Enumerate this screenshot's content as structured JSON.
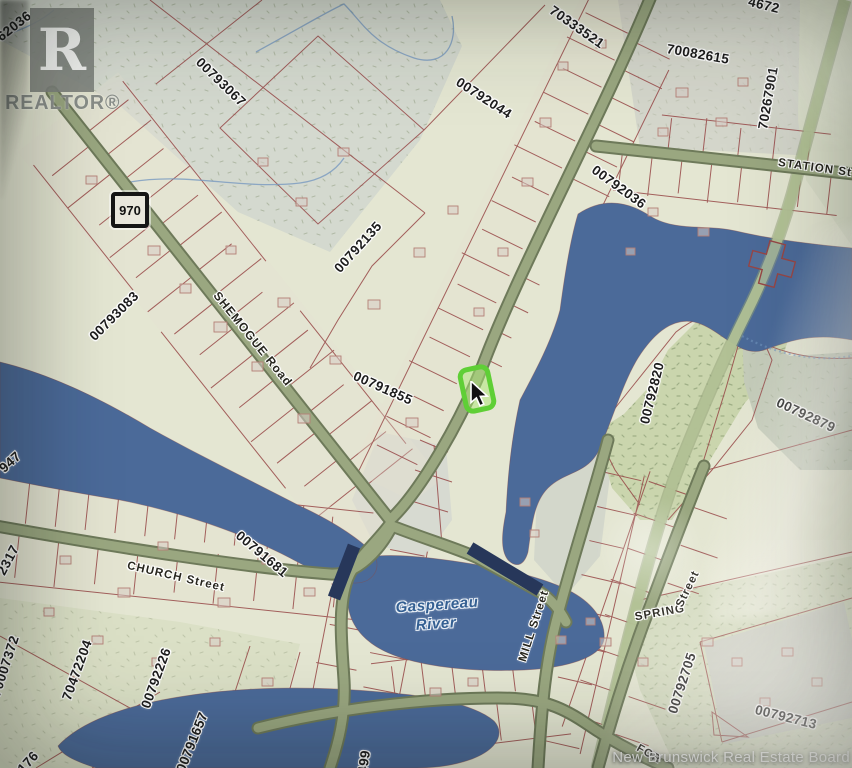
{
  "branding": {
    "logo_letter": "R",
    "logo_text": "REALTOR®",
    "credit": "New Brunswick Real Estate Board"
  },
  "route_shield": {
    "number": "970"
  },
  "selection": {
    "highlight_color": "#58d32b"
  },
  "cursor": {
    "icon": "arrow-pointer"
  },
  "colors": {
    "water": "#486a9d",
    "land": "#e6e8d2",
    "road": "#9aa87e",
    "rail_strip": "#b3c493",
    "parcel_line": "#9c4444",
    "bridge": "#24365c",
    "highlight": "#58d32b",
    "label_halo": "#ffffff"
  },
  "labels": {
    "parcels": [
      {
        "text": "62036",
        "x": 14,
        "y": 26,
        "rot": -38
      },
      {
        "text": "00793067",
        "x": 221,
        "y": 82,
        "rot": 44
      },
      {
        "text": "00792044",
        "x": 484,
        "y": 98,
        "rot": 33
      },
      {
        "text": "70333521",
        "x": 577,
        "y": 27,
        "rot": 35
      },
      {
        "text": "4672",
        "x": 764,
        "y": 5,
        "rot": 14
      },
      {
        "text": "70082615",
        "x": 698,
        "y": 54,
        "rot": 10
      },
      {
        "text": "70267901",
        "x": 768,
        "y": 98,
        "rot": -80
      },
      {
        "text": "00792036",
        "x": 619,
        "y": 187,
        "rot": 36
      },
      {
        "text": "00792135",
        "x": 358,
        "y": 247,
        "rot": -48
      },
      {
        "text": "00793083",
        "x": 114,
        "y": 316,
        "rot": -45
      },
      {
        "text": "00791855",
        "x": 383,
        "y": 388,
        "rot": 24
      },
      {
        "text": "00792820",
        "x": 652,
        "y": 393,
        "rot": -76
      },
      {
        "text": "00792879",
        "x": 806,
        "y": 415,
        "rot": 25
      },
      {
        "text": "947",
        "x": 10,
        "y": 462,
        "rot": -42
      },
      {
        "text": "2317",
        "x": 8,
        "y": 560,
        "rot": -62
      },
      {
        "text": "00791681",
        "x": 262,
        "y": 554,
        "rot": 40
      },
      {
        "text": "70007372",
        "x": 5,
        "y": 666,
        "rot": -72
      },
      {
        "text": "70472204",
        "x": 77,
        "y": 670,
        "rot": -70
      },
      {
        "text": "00792226",
        "x": 156,
        "y": 678,
        "rot": -70
      },
      {
        "text": "00791657",
        "x": 192,
        "y": 742,
        "rot": -68
      },
      {
        "text": "176",
        "x": 28,
        "y": 762,
        "rot": -48
      },
      {
        "text": "499",
        "x": 364,
        "y": 762,
        "rot": -82
      },
      {
        "text": "00792705",
        "x": 682,
        "y": 683,
        "rot": -72
      },
      {
        "text": "00792713",
        "x": 786,
        "y": 717,
        "rot": 14
      }
    ],
    "roads": [
      {
        "text": "SHEMOGUE Road",
        "x": 253,
        "y": 339,
        "rot": 51,
        "size": 12
      },
      {
        "text": "CHURCH Street",
        "x": 176,
        "y": 577,
        "rot": 13
      },
      {
        "text": "STATION St",
        "x": 815,
        "y": 168,
        "rot": 8
      },
      {
        "text": "MILL Street",
        "x": 534,
        "y": 626,
        "rot": -72
      },
      {
        "text": "SPRING",
        "x": 660,
        "y": 613,
        "rot": -10
      },
      {
        "text": "Street",
        "x": 688,
        "y": 589,
        "rot": -64
      },
      {
        "text": "FOR",
        "x": 649,
        "y": 754,
        "rot": 30,
        "size": 11
      }
    ],
    "water": [
      {
        "text": "Gaspereau",
        "x": 437,
        "y": 605,
        "rot": -4
      },
      {
        "text": "River",
        "x": 436,
        "y": 624,
        "rot": -4
      }
    ]
  }
}
